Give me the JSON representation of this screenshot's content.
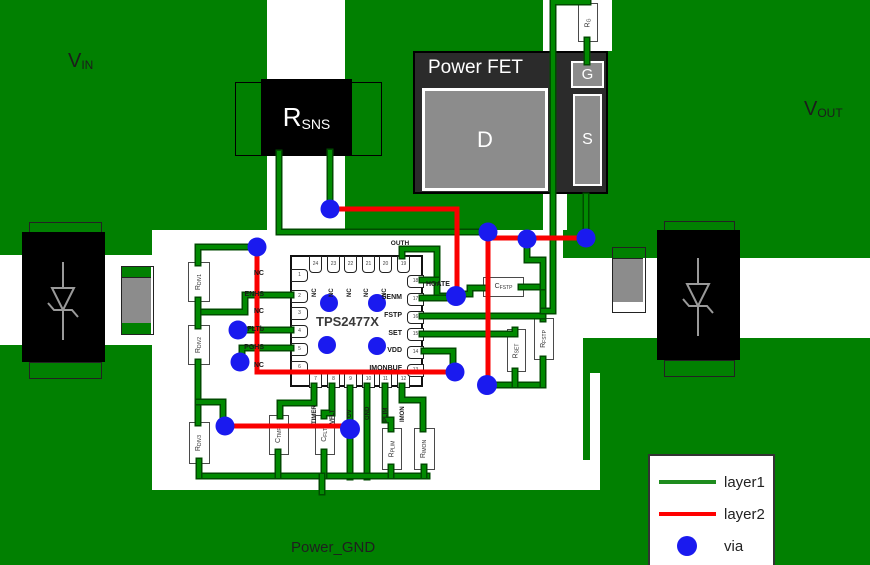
{
  "title_labels": {
    "vin_main": "V",
    "vin_sub": "IN",
    "vout_main": "V",
    "vout_sub": "OUT",
    "power_gnd": "Power_GND"
  },
  "fet": {
    "title": "Power FET",
    "drain": "D",
    "gate": "G",
    "source": "S"
  },
  "rsns": {
    "main": "R",
    "sub": "SNS"
  },
  "ic": {
    "name": "TPS2477X",
    "pins_top": [
      {
        "num": "24",
        "label": "NC"
      },
      {
        "num": "23",
        "label": "NC"
      },
      {
        "num": "22",
        "label": "NC"
      },
      {
        "num": "21",
        "label": "NC"
      },
      {
        "num": "20",
        "label": "NC"
      },
      {
        "num": "19",
        "label": "OUTH"
      }
    ],
    "pins_left": [
      {
        "num": "1",
        "label": "NC"
      },
      {
        "num": "2",
        "label": "ENHS"
      },
      {
        "num": "3",
        "label": "NC"
      },
      {
        "num": "4",
        "label": "FLTb"
      },
      {
        "num": "5",
        "label": "PGHS"
      },
      {
        "num": "6",
        "label": "NC"
      }
    ],
    "pins_right": [
      {
        "num": "18",
        "label": "HGATE"
      },
      {
        "num": "17",
        "label": "SENM"
      },
      {
        "num": "16",
        "label": "FSTP"
      },
      {
        "num": "15",
        "label": "SET"
      },
      {
        "num": "14",
        "label": "VDD"
      },
      {
        "num": "13",
        "label": "IMONBUF"
      }
    ],
    "pins_bottom": [
      {
        "num": "7",
        "label": "TIMER"
      },
      {
        "num": "8",
        "label": "VFLT"
      },
      {
        "num": "9",
        "label": "OV"
      },
      {
        "num": "10",
        "label": "GND"
      },
      {
        "num": "11",
        "label": "PLIM"
      },
      {
        "num": "12",
        "label": "IMON"
      }
    ]
  },
  "components": {
    "r_g": {
      "main": "R",
      "sub": "G"
    },
    "r_div1": {
      "main": "R",
      "sub": "DIV1"
    },
    "r_div2": {
      "main": "R",
      "sub": "DIV2"
    },
    "r_div3": {
      "main": "R",
      "sub": "DIV3"
    },
    "c_tmr": {
      "main": "C",
      "sub": "TMR"
    },
    "c_flt": {
      "main": "C",
      "sub": "FLT"
    },
    "r_plim": {
      "main": "R",
      "sub": "PLIM"
    },
    "r_imon": {
      "main": "R",
      "sub": "IMON"
    },
    "c_fstp": {
      "main": "C",
      "sub": "FSTP"
    },
    "r_set": {
      "main": "R",
      "sub": "SET"
    },
    "r_fstp": {
      "main": "R",
      "sub": "FSTP"
    }
  },
  "legend": {
    "items": [
      {
        "label": "layer1",
        "type": "line",
        "color": "#1e8c1e"
      },
      {
        "label": "layer2",
        "type": "line",
        "color": "#ff0000"
      },
      {
        "label": "via",
        "type": "dot",
        "color": "#1a1aef"
      }
    ]
  },
  "colors": {
    "board_green": "#018001",
    "trace_green": "#018a01",
    "trace_green_edge": "#004b00",
    "trace_red": "#fa0000",
    "via_blue": "#1a1aef",
    "fet_body": "#2b2b2b",
    "component_black": "#000000",
    "pad_gray": "#8c8c8c"
  }
}
